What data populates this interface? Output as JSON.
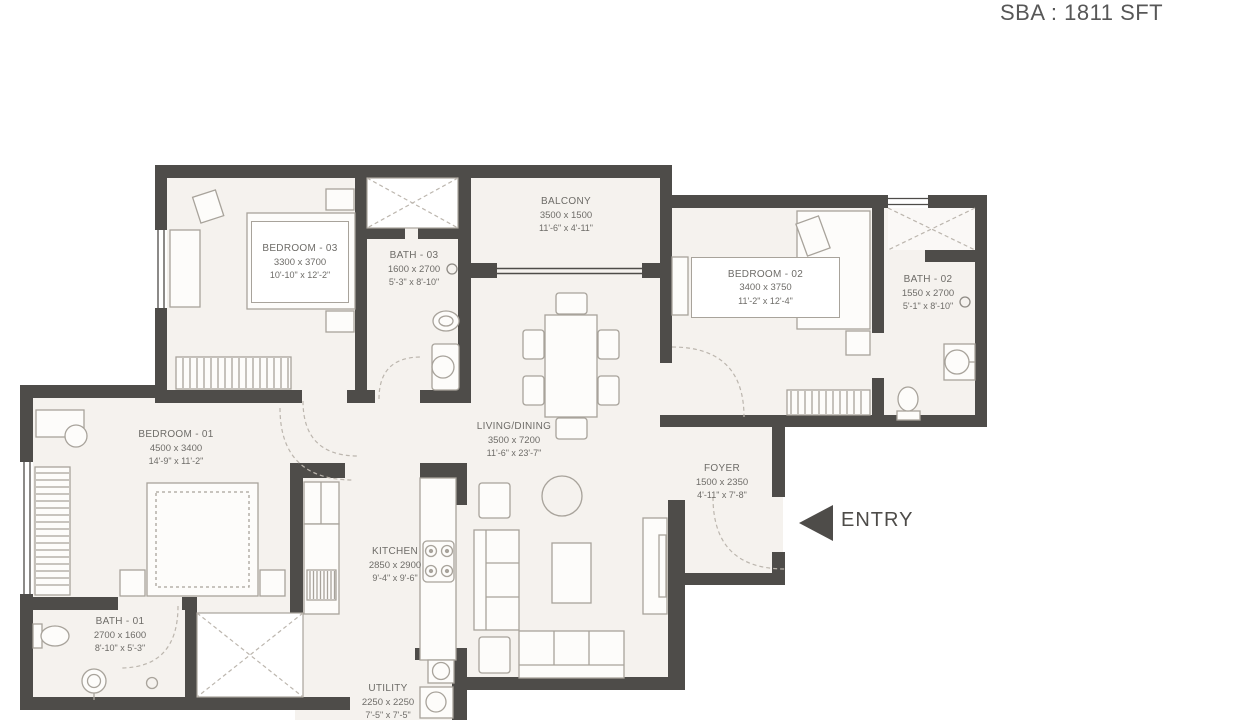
{
  "header": {
    "sba_label": "SBA : 1811 SFT"
  },
  "entry": {
    "label": "ENTRY"
  },
  "rooms": {
    "bedroom3": {
      "name": "BEDROOM - 03",
      "mm": "3300 x 3700",
      "ft": "10'-10\" x 12'-2\""
    },
    "bath3": {
      "name": "BATH - 03",
      "mm": "1600 x 2700",
      "ft": "5'-3\" x 8'-10\""
    },
    "balcony": {
      "name": "BALCONY",
      "mm": "3500 x 1500",
      "ft": "11'-6\" x 4'-11\""
    },
    "bedroom2": {
      "name": "BEDROOM - 02",
      "mm": "3400 x 3750",
      "ft": "11'-2\" x 12'-4\""
    },
    "bath2": {
      "name": "BATH - 02",
      "mm": "1550 x 2700",
      "ft": "5'-1\" x 8'-10\""
    },
    "living": {
      "name": "LIVING/DINING",
      "mm": "3500 x 7200",
      "ft": "11'-6\" x 23'-7\""
    },
    "foyer": {
      "name": "FOYER",
      "mm": "1500 x 2350",
      "ft": "4'-11\" x 7'-8\""
    },
    "bedroom1": {
      "name": "BEDROOM - 01",
      "mm": "4500 x 3400",
      "ft": "14'-9\" x 11'-2\""
    },
    "bath1": {
      "name": "BATH - 01",
      "mm": "2700 x 1600",
      "ft": "8'-10\" x 5'-3\""
    },
    "kitchen": {
      "name": "KITCHEN",
      "mm": "2850 x 2900",
      "ft": "9'-4\" x 9'-6\""
    },
    "utility": {
      "name": "UTILITY",
      "mm": "2250 x 2250",
      "ft": "7'-5\" x 7'-5\""
    }
  },
  "colors": {
    "wall": "#4e4c49",
    "floor": "#f5f2ee",
    "furniture": "#a8a39b",
    "dash": "#bcb6ae",
    "text": "#6e6c68"
  }
}
